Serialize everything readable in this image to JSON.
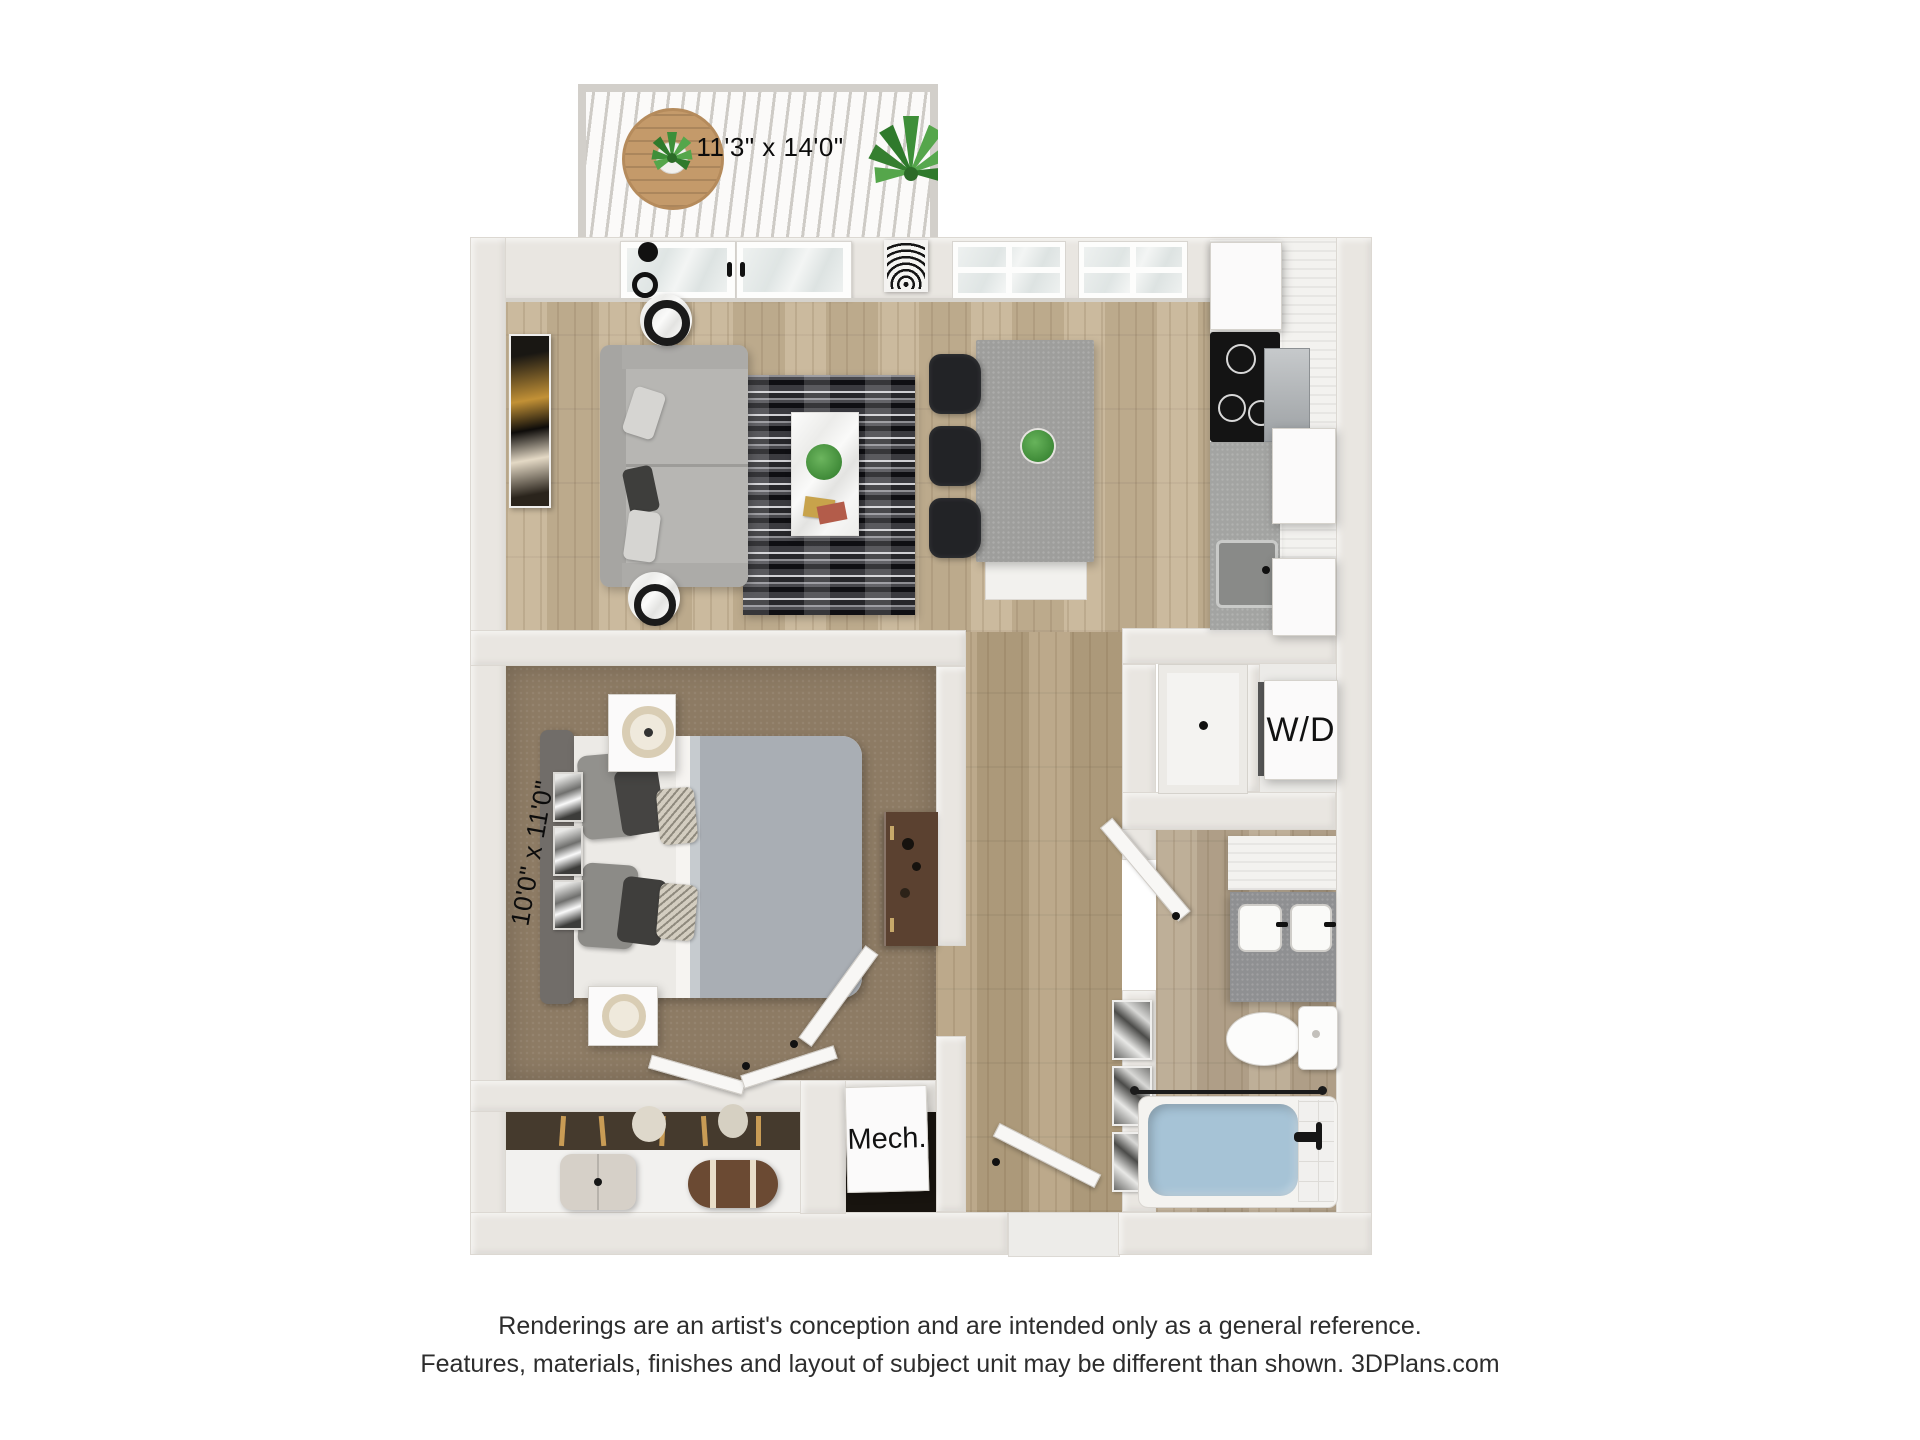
{
  "labels": {
    "living_dimensions": "11'3\" x 14'0\"",
    "bedroom_dimensions": "10'0\" x 11'0\"",
    "washer_dryer": "W/D",
    "mechanical": "Mech."
  },
  "footer": {
    "line1": "Renderings are an artist's conception and are intended only as a general reference.",
    "line2": "Features, materials, finishes and layout of subject unit may be different than shown. 3DPlans.com"
  },
  "palette": {
    "wall": "#e9e6e1",
    "wood_floor": "#c6b394",
    "bedroom_carpet": "#8d7b64",
    "tub": "#a6c3d6",
    "island_counter": "#9e9e9c",
    "label_text": "#0c0c0c"
  }
}
